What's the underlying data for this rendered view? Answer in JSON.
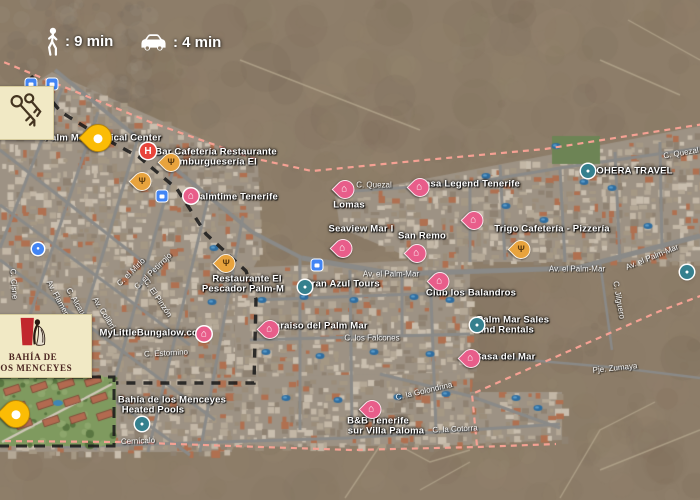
{
  "badges": {
    "walk_label": ": 9 min",
    "drive_label": ": 4 min"
  },
  "logo_cards": {
    "bahia": {
      "line1": "BAHÍA DE",
      "line2": "LOS MENCEYES"
    }
  },
  "colors": {
    "boundary_dash": "#f5a193",
    "route_dash": "#1b1b1b",
    "gold_pin": "#fbbc05",
    "food_pin": "#e8a33d",
    "lodging_pink": "#e85d8a",
    "hospital_red": "#e8453c",
    "teal_marker": "#35808e",
    "transit_blue": "#4285f4",
    "label_white": "#ffffff",
    "card_cream": "#f1e9c5"
  },
  "pois": [
    {
      "text": "Palm Mar Medical Center",
      "x": 103,
      "y": 138
    },
    {
      "text": "Bar Cafetería Restaurante",
      "x": 216,
      "y": 152
    },
    {
      "text": "Hamburguesería El",
      "x": 212,
      "y": 162
    },
    {
      "text": "palmtime Tenerife",
      "x": 236,
      "y": 197
    },
    {
      "text": "Casa Legend Tenerife",
      "x": 469,
      "y": 184
    },
    {
      "text": "Lomas",
      "x": 349,
      "y": 205
    },
    {
      "text": "Seaview Mar I",
      "x": 361,
      "y": 229
    },
    {
      "text": "San Remo",
      "x": 422,
      "y": 236
    },
    {
      "text": "BOHERA TRAVEL",
      "x": 631,
      "y": 171
    },
    {
      "text": "Trigo Cafetería - Pizzería",
      "x": 552,
      "y": 229
    },
    {
      "text": "Gran Azul Tours",
      "x": 342,
      "y": 284
    },
    {
      "text": "Restaurante El",
      "x": 247,
      "y": 279
    },
    {
      "text": "Pescador Palm-M",
      "x": 243,
      "y": 289
    },
    {
      "text": "MyLittleBungalow.com",
      "x": 153,
      "y": 333
    },
    {
      "text": "Paraiso del Palm Mar",
      "x": 318,
      "y": 326
    },
    {
      "text": "Club los Balandros",
      "x": 471,
      "y": 293
    },
    {
      "text": "Palm Mar Sales",
      "x": 513,
      "y": 320
    },
    {
      "text": "and Rentals",
      "x": 506,
      "y": 330
    },
    {
      "text": "Casa del Mar",
      "x": 505,
      "y": 357
    },
    {
      "text": "B&B Tenerife",
      "x": 378,
      "y": 421
    },
    {
      "text": "sur Villa Paloma",
      "x": 386,
      "y": 431
    },
    {
      "text": "Bahía de los Menceyes",
      "x": 172,
      "y": 400
    },
    {
      "text": "Heated Pools",
      "x": 153,
      "y": 410
    }
  ],
  "streets": [
    {
      "text": "C. Quezal",
      "x": 374,
      "y": 185,
      "rot": 0
    },
    {
      "text": "C. Quezal",
      "x": 681,
      "y": 153,
      "rot": -10
    },
    {
      "text": "Av. el Palm-Mar",
      "x": 391,
      "y": 274,
      "rot": 0
    },
    {
      "text": "Av. el Palm-Mar",
      "x": 577,
      "y": 269,
      "rot": 0
    },
    {
      "text": "Av. el Palm-Mar",
      "x": 652,
      "y": 257,
      "rot": -22
    },
    {
      "text": "C. los Falcones",
      "x": 372,
      "y": 338,
      "rot": 0
    },
    {
      "text": "C. la Golondrina",
      "x": 424,
      "y": 391,
      "rot": -13
    },
    {
      "text": "C. la Cotorra",
      "x": 455,
      "y": 429,
      "rot": -3
    },
    {
      "text": "Pje. Zumaya",
      "x": 615,
      "y": 368,
      "rot": -6
    },
    {
      "text": "C. Jilguero",
      "x": 619,
      "y": 300,
      "rot": 80
    },
    {
      "text": "C. Estornino",
      "x": 166,
      "y": 353,
      "rot": -3
    },
    {
      "text": "Cernícalo",
      "x": 138,
      "y": 441,
      "rot": -2
    },
    {
      "text": "C. el Mirlo",
      "x": 131,
      "y": 272,
      "rot": -45
    },
    {
      "text": "C. el Petirrojo",
      "x": 153,
      "y": 271,
      "rot": -44
    },
    {
      "text": "C. El Pinzón",
      "x": 158,
      "y": 298,
      "rot": 56
    },
    {
      "text": "Av. Colibrí",
      "x": 104,
      "y": 313,
      "rot": 58
    },
    {
      "text": "C. Alcaudón",
      "x": 79,
      "y": 307,
      "rot": 60
    },
    {
      "text": "Av. Flamenco",
      "x": 60,
      "y": 302,
      "rot": 62
    },
    {
      "text": "C. Cisne",
      "x": 14,
      "y": 284,
      "rot": 86
    }
  ],
  "pins": [
    {
      "type": "gold",
      "x": 98,
      "y": 152
    },
    {
      "type": "gold",
      "x": 16,
      "y": 428
    },
    {
      "type": "food",
      "x": 171,
      "y": 172
    },
    {
      "type": "food",
      "x": 142,
      "y": 191
    },
    {
      "type": "food",
      "x": 226,
      "y": 273
    },
    {
      "type": "food",
      "x": 521,
      "y": 259
    },
    {
      "type": "hospital",
      "x": 148,
      "y": 151
    },
    {
      "type": "lodging_circle",
      "x": 191,
      "y": 196
    },
    {
      "type": "lodging_circle",
      "x": 204,
      "y": 334
    },
    {
      "type": "lodging",
      "x": 345,
      "y": 199
    },
    {
      "type": "lodging",
      "x": 420,
      "y": 197
    },
    {
      "type": "lodging",
      "x": 343,
      "y": 258
    },
    {
      "type": "lodging",
      "x": 417,
      "y": 263
    },
    {
      "type": "lodging",
      "x": 474,
      "y": 230
    },
    {
      "type": "lodging",
      "x": 440,
      "y": 291
    },
    {
      "type": "lodging",
      "x": 471,
      "y": 368
    },
    {
      "type": "lodging",
      "x": 270,
      "y": 339
    },
    {
      "type": "lodging",
      "x": 372,
      "y": 419
    },
    {
      "type": "teal",
      "x": 305,
      "y": 287
    },
    {
      "type": "teal",
      "x": 477,
      "y": 325
    },
    {
      "type": "teal",
      "x": 142,
      "y": 424
    },
    {
      "type": "teal",
      "x": 588,
      "y": 171
    },
    {
      "type": "teal",
      "x": 687,
      "y": 272
    },
    {
      "type": "transit",
      "x": 31,
      "y": 84
    },
    {
      "type": "transit",
      "x": 52,
      "y": 84
    },
    {
      "type": "transit",
      "x": 162,
      "y": 196
    },
    {
      "type": "transit",
      "x": 317,
      "y": 265
    },
    {
      "type": "shop",
      "x": 38,
      "y": 249
    }
  ]
}
